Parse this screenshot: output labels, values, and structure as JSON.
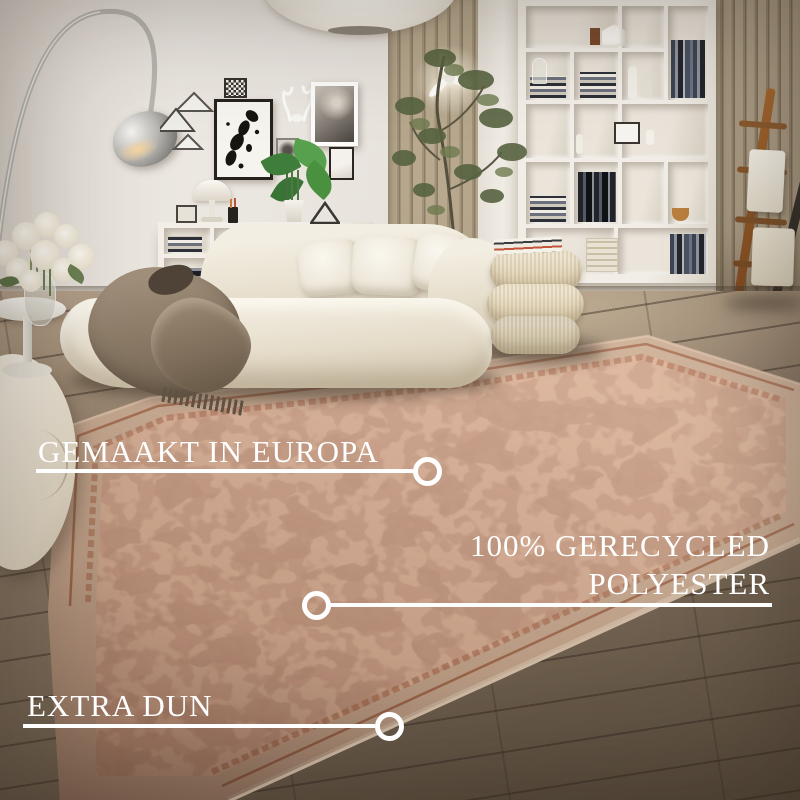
{
  "annotations": {
    "made_in": "GEMAAKT IN EUROPA",
    "material_line1": "100% GERECYCLED",
    "material_line2": "POLYESTER",
    "extra_thin": "EXTRA DUN"
  },
  "palette": {
    "annotation_white": "#ffffff",
    "wall": "#e9e4de",
    "wood_slat": "#a99a80",
    "floor_light": "#ab977f",
    "floor_dark": "#554a3e",
    "bookshelf_white": "#f2eee7",
    "rug_base": "#c9ab92",
    "rug_field": "#c69d84",
    "rug_pattern": "#b06f4e",
    "rug_pattern_dark": "#8e5138",
    "rug_border_line": "#9d6043",
    "sofa_cream": "#ece4d4",
    "pillow_white": "#f6f2e8",
    "blanket_taupe": "#84745f",
    "pouf_cream": "#e7dcc4",
    "plant_green": "#4d8a44",
    "ladder_wood": "#995d2e",
    "ladder_dark": "#37332e"
  }
}
